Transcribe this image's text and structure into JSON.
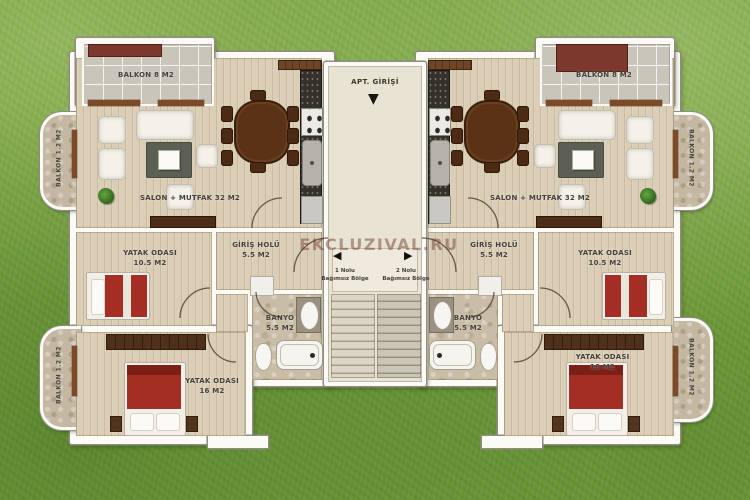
{
  "watermark": "EKCLUZIVAL.RU",
  "entrance": {
    "label": "APT. GİRİŞİ"
  },
  "icons": {
    "entrance_arrow": "▼",
    "stair_arrow_left": "◀",
    "stair_arrow_right": "▶"
  },
  "stairwell": {
    "zone_left_line1": "1 Nolu",
    "zone_left_line2": "Bağımsız Bölge",
    "zone_right_line1": "2 Nolu",
    "zone_right_line2": "Bağımsız Bölge"
  },
  "rooms": {
    "left": {
      "balcony": "BALKON 8 M2",
      "salon": "SALON + MUTFAK 32 M2",
      "bedroom1_name": "YATAK ODASI",
      "bedroom1_area": "10.5 M2",
      "hall_name": "GİRİŞ HOLÜ",
      "hall_area": "5.5 M2",
      "bathroom_name": "BANYO",
      "bathroom_area": "5.5 M2",
      "bedroom2_name": "YATAK ODASI",
      "bedroom2_area": "16 M2",
      "side_balcony_top": "BALKON 1.2 M2",
      "side_balcony_bottom": "BALKON 1.2 M2"
    },
    "right": {
      "balcony": "BALKON 8 M2",
      "salon": "SALON + MUTFAK 32 M2",
      "bedroom1_name": "YATAK ODASI",
      "bedroom1_area": "10.5 M2",
      "hall_name": "GİRİŞ HOLÜ",
      "hall_area": "5.5 M2",
      "bathroom_name": "BANYO",
      "bathroom_area": "5.5 M2",
      "bedroom2_name": "YATAK ODASI",
      "bedroom2_area": "16 M2",
      "side_balcony_top": "BALKON 1.2 M2",
      "side_balcony_bottom": "BALKON 1.2 M2"
    }
  },
  "palette": {
    "grass": "#79a441",
    "wood_floor": "#dbceb6",
    "balcony_tile": "#c9c5bb",
    "hall_floor": "#e9e3d4",
    "bed_red": "#a52e24",
    "awning_maroon": "#7d382e",
    "wall_white": "#fbfaf5"
  }
}
